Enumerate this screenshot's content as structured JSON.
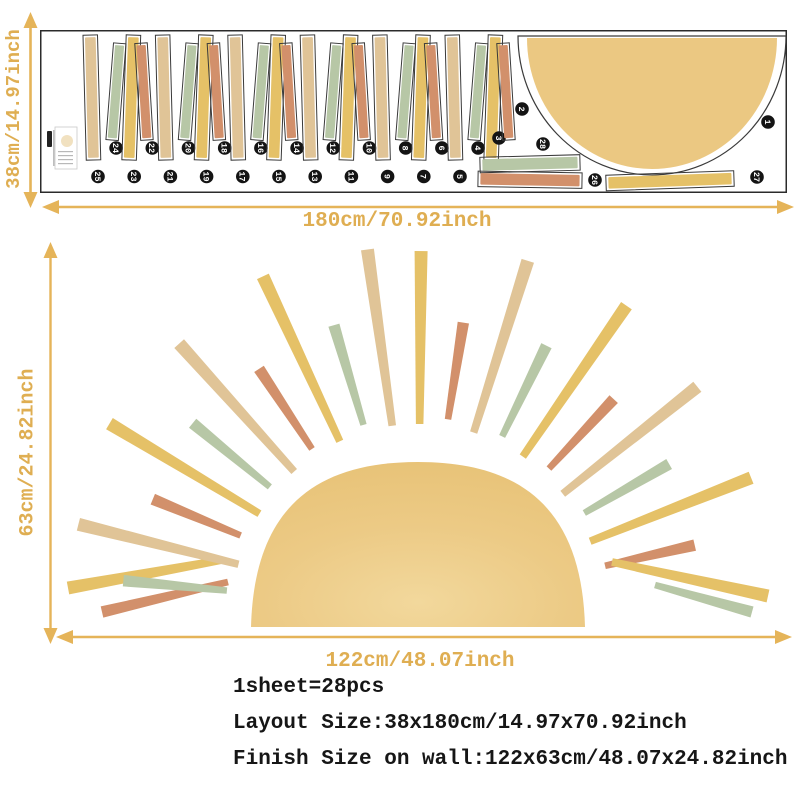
{
  "title": "Sun wall decal size diagram",
  "colors": {
    "gold_arrow": "#E5B459",
    "gold_text": "#DFAE52",
    "yellow": "#E5C167",
    "tan": "#E0C497",
    "green": "#B7C7A6",
    "orange": "#D2906B",
    "sun_fill": "#EBC882",
    "sun_light": "#F2D89C",
    "outline": "#3A3A3A",
    "circle_bg": "#141414",
    "circle_text": "#FFFFFF",
    "info_text": "#161616"
  },
  "sheet": {
    "height_label": "38cm/14.97inch",
    "width_label": "180cm/70.92inch",
    "sun_piece": {
      "n": 1
    },
    "rays": [
      {
        "n": 25,
        "c": "tan",
        "tall": true
      },
      {
        "n": 24,
        "c": "green",
        "tall": false
      },
      {
        "n": 23,
        "c": "yellow",
        "tall": true
      },
      {
        "n": 22,
        "c": "orange",
        "tall": false
      },
      {
        "n": 21,
        "c": "tan",
        "tall": true
      },
      {
        "n": 20,
        "c": "green",
        "tall": false
      },
      {
        "n": 19,
        "c": "yellow",
        "tall": true
      },
      {
        "n": 18,
        "c": "orange",
        "tall": false
      },
      {
        "n": 17,
        "c": "tan",
        "tall": true
      },
      {
        "n": 16,
        "c": "green",
        "tall": false
      },
      {
        "n": 15,
        "c": "yellow",
        "tall": true
      },
      {
        "n": 14,
        "c": "orange",
        "tall": false
      },
      {
        "n": 13,
        "c": "tan",
        "tall": true
      },
      {
        "n": 12,
        "c": "green",
        "tall": false
      },
      {
        "n": 11,
        "c": "yellow",
        "tall": true
      },
      {
        "n": 10,
        "c": "orange",
        "tall": false
      },
      {
        "n": 9,
        "c": "tan",
        "tall": true
      },
      {
        "n": 8,
        "c": "green",
        "tall": false
      },
      {
        "n": 7,
        "c": "yellow",
        "tall": true
      },
      {
        "n": 6,
        "c": "orange",
        "tall": false
      },
      {
        "n": 5,
        "c": "tan",
        "tall": true
      },
      {
        "n": 4,
        "c": "green",
        "tall": false
      },
      {
        "n": 3,
        "c": "yellow",
        "tall": true
      },
      {
        "n": 2,
        "c": "orange",
        "tall": false
      }
    ],
    "strips": [
      {
        "n": 28,
        "c": "green"
      },
      {
        "n": 26,
        "c": "orange"
      },
      {
        "n": 27,
        "c": "yellow"
      }
    ]
  },
  "wall": {
    "height_label": "63cm/24.82inch",
    "width_label": "122cm/48.07inch",
    "rays": [
      {
        "c": "orange",
        "t": "short",
        "pts": [
          178,
          339,
          52,
          369
        ]
      },
      {
        "c": "yellow",
        "t": "long",
        "pts": [
          172,
          317,
          18,
          345
        ]
      },
      {
        "c": "green",
        "t": "short",
        "a": 174.5,
        "r1": 296
      },
      {
        "c": "tan",
        "t": "long",
        "a": 166,
        "r1": 350
      },
      {
        "c": "orange",
        "t": "short",
        "a": 157.5,
        "r1": 287
      },
      {
        "c": "yellow",
        "t": "long",
        "a": 149,
        "r1": 360
      },
      {
        "c": "green",
        "t": "short",
        "a": 140.5,
        "r1": 292
      },
      {
        "c": "tan",
        "t": "long",
        "a": 132,
        "r1": 357
      },
      {
        "c": "orange",
        "t": "short",
        "a": 123.5,
        "r1": 288
      },
      {
        "c": "yellow",
        "t": "long",
        "a": 115,
        "r1": 367
      },
      {
        "c": "green",
        "t": "short",
        "a": 106.5,
        "r1": 296
      },
      {
        "c": "tan",
        "t": "long",
        "a": 98,
        "r1": 363
      },
      {
        "c": "yellow",
        "t": "long",
        "a": 89.5,
        "r1": 358
      },
      {
        "c": "orange",
        "t": "short",
        "a": 81,
        "r1": 290
      },
      {
        "c": "tan",
        "t": "long",
        "a": 72.5,
        "r1": 365
      },
      {
        "c": "green",
        "t": "short",
        "a": 64,
        "r1": 293
      },
      {
        "c": "yellow",
        "t": "long",
        "a": 55.5,
        "r1": 368
      },
      {
        "c": "orange",
        "t": "short",
        "a": 47,
        "r1": 287
      },
      {
        "c": "tan",
        "t": "long",
        "a": 38.5,
        "r1": 357
      },
      {
        "c": "green",
        "t": "short",
        "a": 30,
        "r1": 290
      },
      {
        "c": "yellow",
        "t": "long",
        "a": 21.5,
        "r1": 358
      },
      {
        "c": "orange",
        "t": "short",
        "a": 13,
        "r1": 284
      },
      {
        "c": "yellow",
        "t": "long",
        "pts": [
          562,
          319,
          718,
          353
        ]
      },
      {
        "c": "green",
        "t": "short",
        "pts": [
          605,
          342,
          702,
          369
        ]
      }
    ]
  },
  "info": {
    "line1": "1sheet=28pcs",
    "line2": "Layout Size:38x180cm/14.97x70.92inch",
    "line3": "Finish Size on wall:122x63cm/48.07x24.82inch"
  }
}
